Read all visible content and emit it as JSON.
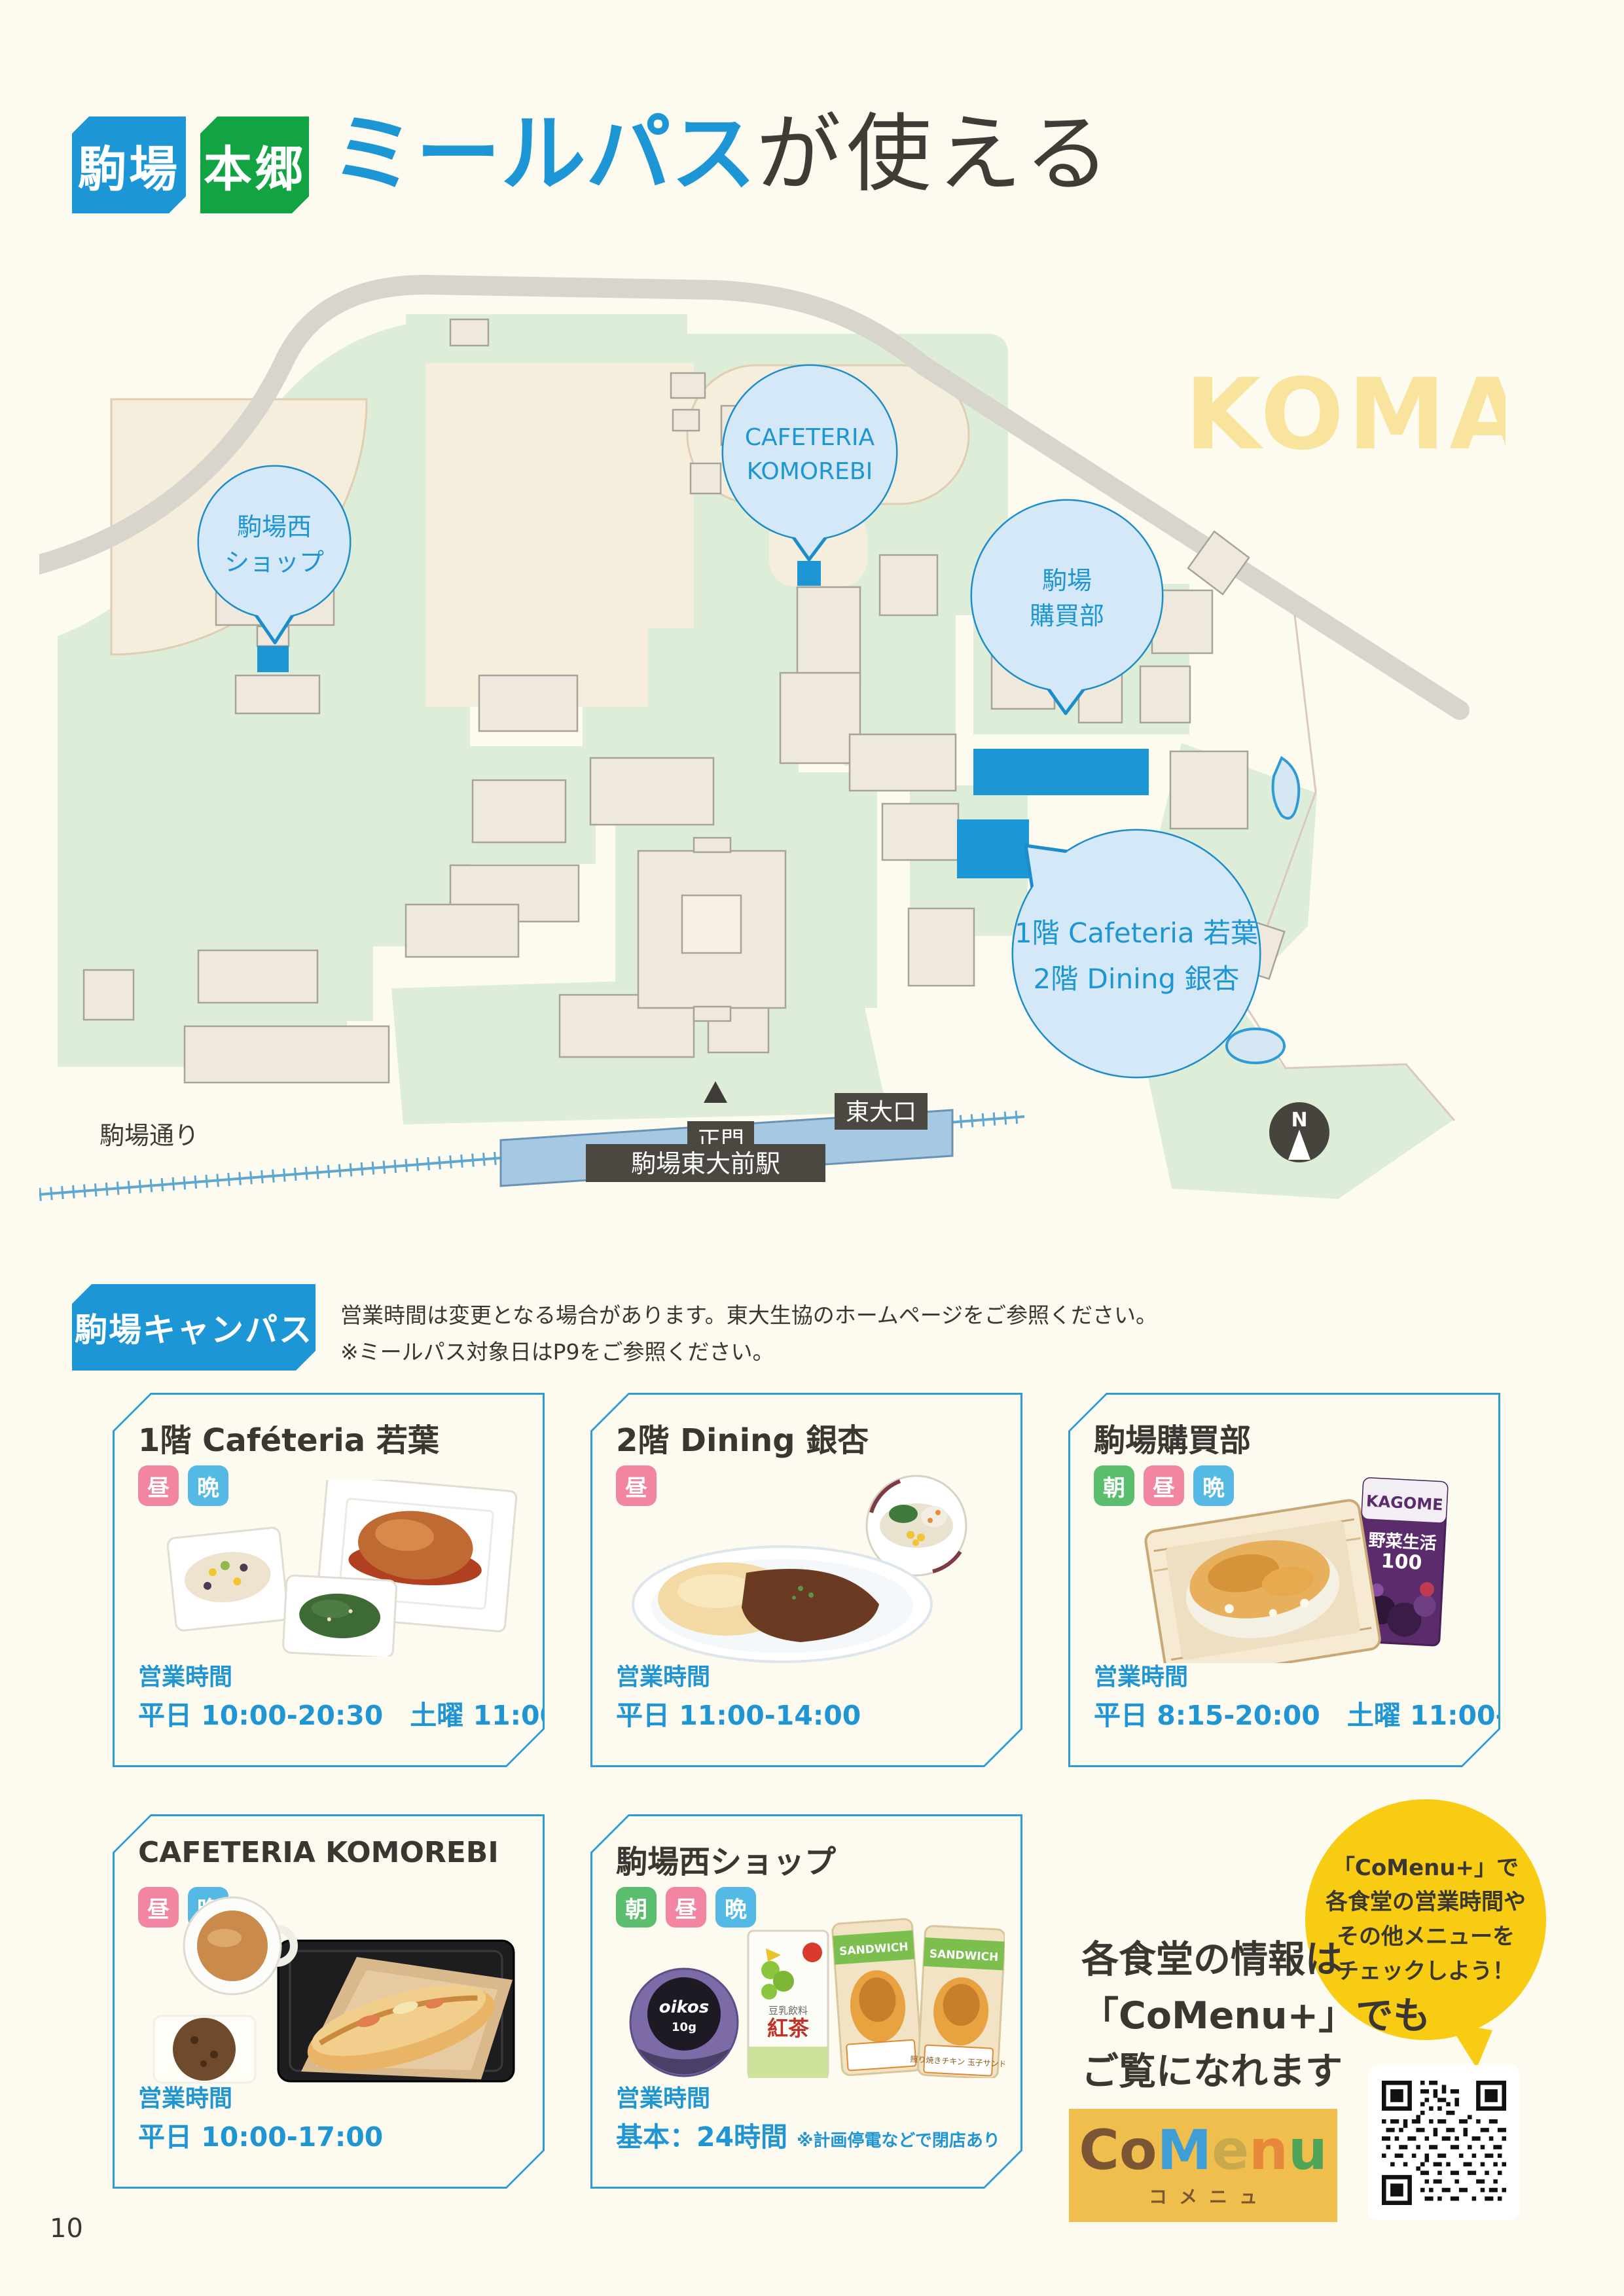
{
  "page": {
    "number": "10"
  },
  "colors": {
    "accent_blue": "#1C96D5",
    "hongo_green": "#12A443",
    "badge_pink": "#F285A2",
    "badge_sky": "#55B9E6",
    "badge_leaf": "#5BBE6E",
    "bubble_fill": "#D5E8F8",
    "bubble_stroke": "#1C8DCB",
    "map_green": "#DEEDD8",
    "map_field": "#F6EEDC",
    "road_gray": "#D8D5CD",
    "dark_label": "#4B4741",
    "watermark_yellow": "#F8E49C",
    "comenu_yellow": "#F8CC12"
  },
  "header": {
    "campus_badges": [
      {
        "label": "駒場"
      },
      {
        "label": "本郷"
      }
    ],
    "title": {
      "highlight": "ミールパス",
      "rest": "が使える"
    }
  },
  "map": {
    "watermark": "KOMABA",
    "compass": "N",
    "labels": {
      "street": "駒場通り",
      "station": "駒場東大前駅",
      "gate_main": "正門",
      "gate_todai": "東大口"
    },
    "bubbles": {
      "west_shop": {
        "line1": "駒場西",
        "line2": "ショップ"
      },
      "komorebi": {
        "line1": "CAFETERIA",
        "line2": "KOMOREBI"
      },
      "kobaibu": {
        "line1": "駒場",
        "line2": "購買部"
      },
      "dining": {
        "line1": "1階 Cafeteria 若葉",
        "line2": "2階 Dining 銀杏"
      }
    }
  },
  "section": {
    "title": "駒場キャンパス",
    "note1": "営業時間は変更となる場合があります。東大生協のホームページをご参照ください。",
    "note2": "※ミールパス対象日はP9をご参照ください。"
  },
  "meal_badges": {
    "morning": "朝",
    "noon": "昼",
    "evening": "晩"
  },
  "cards": [
    {
      "title": "1階 Caféteria 若葉",
      "hours_label": "営業時間",
      "hours": "平日 10:00-20:30　土曜 11:00-14:00"
    },
    {
      "title": "2階 Dining 銀杏",
      "hours_label": "営業時間",
      "hours": "平日 11:00-14:00"
    },
    {
      "title": "駒場購買部",
      "hours_label": "営業時間",
      "hours": "平日 8:15-20:00　土曜 11:00-14:00",
      "photo_labels": {
        "brand": "KAGOME",
        "product": "野菜生活",
        "number": "100"
      }
    },
    {
      "title": "CAFETERIA KOMOREBI",
      "hours_label": "営業時間",
      "hours": "平日 10:00-17:00"
    },
    {
      "title": "駒場西ショップ",
      "hours_label": "営業時間",
      "hours": "基本：24時間",
      "hours_note": "※計画停電などで閉店あり",
      "photo_labels": {
        "yogurt": "oikos",
        "grams": "10g",
        "soy": "豆乳飲料",
        "tea": "紅茶",
        "sandwich": "SANDWICH",
        "sandwich_label": "照り焼きチキン 玉子サンド"
      }
    }
  ],
  "comenu": {
    "info_lines": [
      "各食堂の情報は",
      "「CoMenu+」でも",
      "ご覧になれます"
    ],
    "bubble_lines": [
      "「CoMenu+」で",
      "各食堂の営業時間や",
      "その他メニューを",
      "チェックしよう！"
    ],
    "logo": {
      "letters": [
        "C",
        "o",
        "M",
        "e",
        "n",
        "u"
      ],
      "kana": "コメニュ"
    }
  }
}
